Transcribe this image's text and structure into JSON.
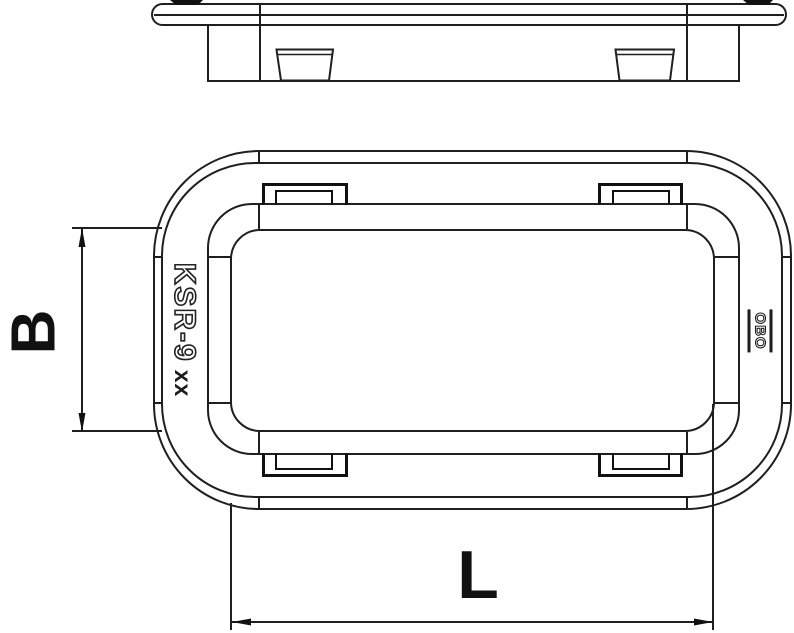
{
  "product": {
    "code": "KSR-9",
    "variant": "xx",
    "brand": "OBO"
  },
  "dimensions": {
    "width_label": "B",
    "length_label": "L"
  },
  "colors": {
    "background": "#ffffff",
    "line": "#1f1f1f",
    "bold_line": "#111111"
  }
}
